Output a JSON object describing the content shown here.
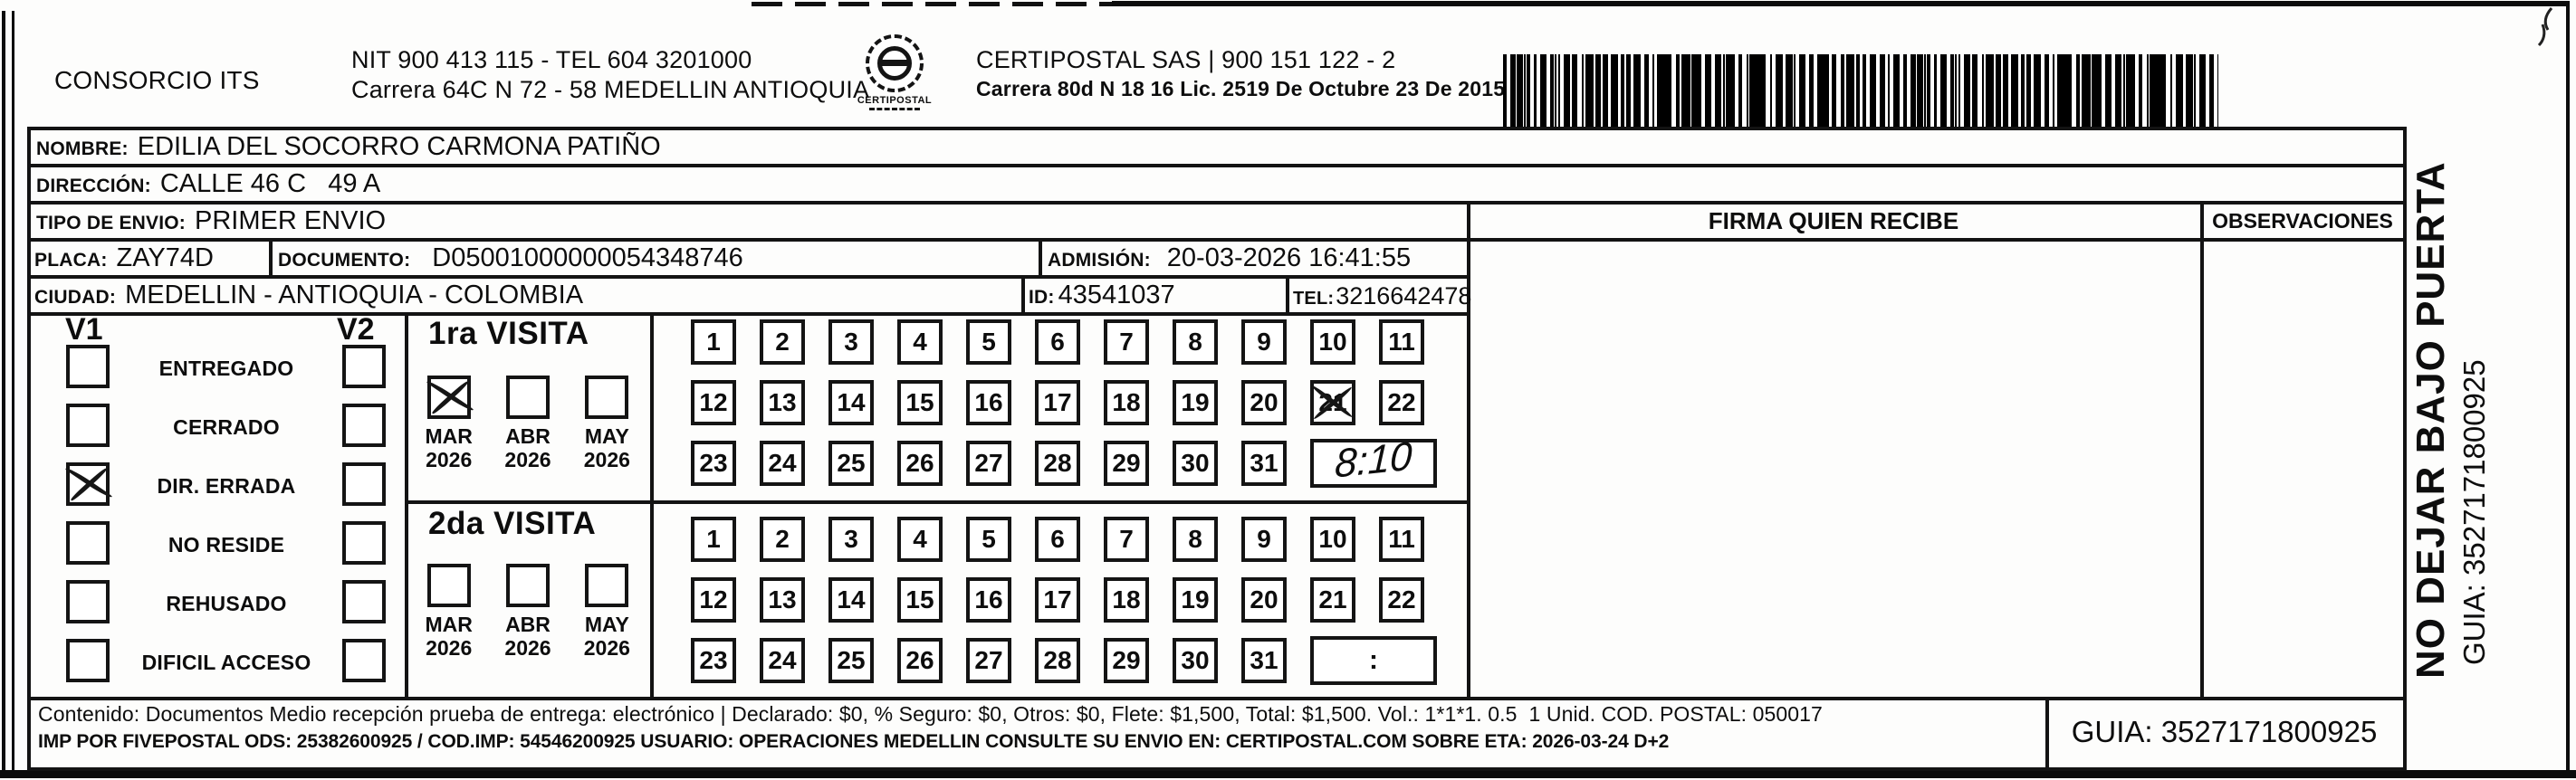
{
  "header": {
    "consorcio": "CONSORCIO ITS",
    "nit_line1": "NIT 900 413 115 - TEL 604 3201000",
    "nit_line2": "Carrera 64C N 72 - 58 MEDELLIN ANTIOQUIA",
    "logo_caption": "CERTIPOSTAL",
    "company_line1": "CERTIPOSTAL SAS | 900 151 122 - 2",
    "company_line2": "Carrera 80d N 18 16  Lic. 2519 De Octubre 23 De 2015"
  },
  "shipment": {
    "nombre_label": "NOMBRE:",
    "nombre": "EDILIA DEL SOCORRO CARMONA PATIÑO",
    "direccion_label": "DIRECCIÓN:",
    "direccion": "CALLE 46 C   49 A",
    "tipo_label": "TIPO DE ENVIO:",
    "tipo": "PRIMER ENVIO",
    "placa_label": "PLACA:",
    "placa": "ZAY74D",
    "documento_label": "DOCUMENTO:",
    "documento": "D05001000000054348746",
    "admision_label": "ADMISIÓN:",
    "admision": "20-03-2026 16:41:55",
    "ciudad_label": "CIUDAD:",
    "ciudad": "MEDELLIN - ANTIOQUIA - COLOMBIA",
    "id_label": "ID:",
    "id_value": "43541037",
    "tel_label": "TEL:",
    "tel": "3216642478"
  },
  "status_panel": {
    "v1_label": "V1",
    "v2_label": "V2",
    "options": [
      {
        "label": "ENTREGADO",
        "v1": false,
        "v2": false
      },
      {
        "label": "CERRADO",
        "v1": false,
        "v2": false
      },
      {
        "label": "DIR. ERRADA",
        "v1": true,
        "v2": false
      },
      {
        "label": "NO RESIDE",
        "v1": false,
        "v2": false
      },
      {
        "label": "REHUSADO",
        "v1": false,
        "v2": false
      },
      {
        "label": "DIFICIL ACCESO",
        "v1": false,
        "v2": false
      }
    ]
  },
  "visits": {
    "first": {
      "title": "1ra VISITA",
      "months": [
        {
          "month": "MAR",
          "year": "2026",
          "checked": true
        },
        {
          "month": "ABR",
          "year": "2026",
          "checked": false
        },
        {
          "month": "MAY",
          "year": "2026",
          "checked": false
        }
      ],
      "days": [
        {
          "n": "1"
        },
        {
          "n": "2"
        },
        {
          "n": "3"
        },
        {
          "n": "4"
        },
        {
          "n": "5"
        },
        {
          "n": "6"
        },
        {
          "n": "7"
        },
        {
          "n": "8"
        },
        {
          "n": "9"
        },
        {
          "n": "10"
        },
        {
          "n": "11"
        },
        {
          "n": "12"
        },
        {
          "n": "13"
        },
        {
          "n": "14"
        },
        {
          "n": "15"
        },
        {
          "n": "16"
        },
        {
          "n": "17"
        },
        {
          "n": "18"
        },
        {
          "n": "19"
        },
        {
          "n": "20"
        },
        {
          "n": "21",
          "crossed": true
        },
        {
          "n": "22"
        },
        {
          "n": "23"
        },
        {
          "n": "24"
        },
        {
          "n": "25"
        },
        {
          "n": "26"
        },
        {
          "n": "27"
        },
        {
          "n": "28"
        },
        {
          "n": "29"
        },
        {
          "n": "30"
        },
        {
          "n": "31"
        }
      ],
      "time": "8:10"
    },
    "second": {
      "title": "2da VISITA",
      "months": [
        {
          "month": "MAR",
          "year": "2026",
          "checked": false
        },
        {
          "month": "ABR",
          "year": "2026",
          "checked": false
        },
        {
          "month": "MAY",
          "year": "2026",
          "checked": false
        }
      ],
      "days": [
        {
          "n": "1"
        },
        {
          "n": "2"
        },
        {
          "n": "3"
        },
        {
          "n": "4"
        },
        {
          "n": "5"
        },
        {
          "n": "6"
        },
        {
          "n": "7"
        },
        {
          "n": "8"
        },
        {
          "n": "9"
        },
        {
          "n": "10"
        },
        {
          "n": "11"
        },
        {
          "n": "12"
        },
        {
          "n": "13"
        },
        {
          "n": "14"
        },
        {
          "n": "15"
        },
        {
          "n": "16"
        },
        {
          "n": "17"
        },
        {
          "n": "18"
        },
        {
          "n": "19"
        },
        {
          "n": "20"
        },
        {
          "n": "21"
        },
        {
          "n": "22"
        },
        {
          "n": "23"
        },
        {
          "n": "24"
        },
        {
          "n": "25"
        },
        {
          "n": "26"
        },
        {
          "n": "27"
        },
        {
          "n": "28"
        },
        {
          "n": "29"
        },
        {
          "n": "30"
        },
        {
          "n": "31"
        }
      ],
      "time": ":"
    }
  },
  "receipt": {
    "firma_header": "FIRMA QUIEN RECIBE",
    "observaciones_header": "OBSERVACIONES"
  },
  "side_panel": {
    "warning": "NO DEJAR BAJO PUERTA",
    "guia": "GUIA: 3527171800925"
  },
  "footer": {
    "line1": "Contenido: Documentos Medio recepción prueba de entrega: electrónico | Declarado: $0, % Seguro: $0, Otros: $0, Flete: $1,500, Total: $1,500. Vol.: 1*1*1. 0.5  1 Unid. COD. POSTAL: 050017",
    "line2": "IMP POR FIVEPOSTAL ODS: 25382600925 / COD.IMP: 54546200925 USUARIO: OPERACIONES MEDELLIN CONSULTE SU ENVIO EN: CERTIPOSTAL.COM SOBRE ETA: 2026-03-24 D+2",
    "guia_box": "GUIA: 3527171800925"
  }
}
